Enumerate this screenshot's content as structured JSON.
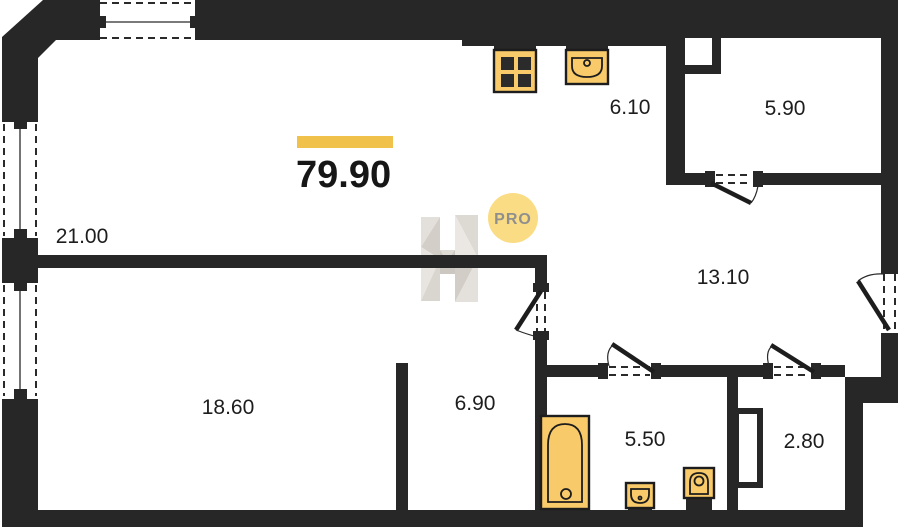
{
  "plan": {
    "total_area": "79.90",
    "watermark_badge": "PRO",
    "rooms": [
      {
        "id": "living",
        "area": "21.00"
      },
      {
        "id": "kitchen",
        "area": "6.10"
      },
      {
        "id": "wardrobe",
        "area": "5.90"
      },
      {
        "id": "hallway",
        "area": "13.10"
      },
      {
        "id": "bedroom",
        "area": "18.60"
      },
      {
        "id": "study",
        "area": "6.90"
      },
      {
        "id": "bathroom",
        "area": "5.50"
      },
      {
        "id": "storage",
        "area": "2.80"
      }
    ],
    "colors": {
      "wall": "#272727",
      "accent_bar": "#F0C14B",
      "fixture_fill": "#F8CA69",
      "badge_bg": "#FADC85",
      "badge_text": "#8F8F8F",
      "label_text": "#1D1D1D"
    }
  }
}
